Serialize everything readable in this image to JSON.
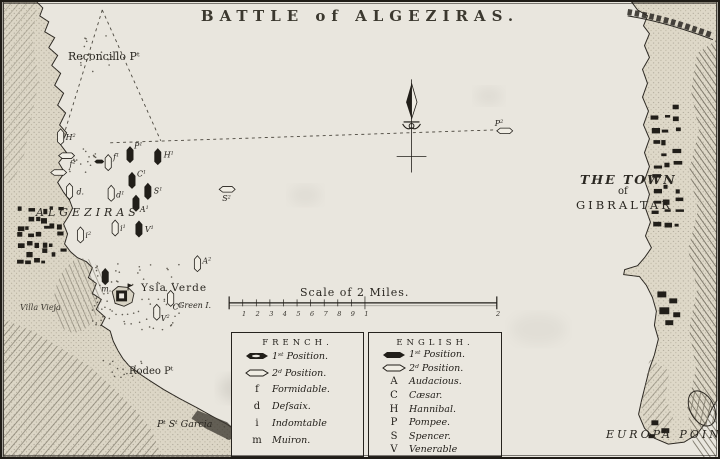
{
  "title": "BATTLE of ALGEZIRAS.",
  "colors": {
    "ink": "#211e19",
    "paper": "#e9e6de",
    "land": "#dcd6c6",
    "ship_fill": "#f0ede4"
  },
  "map_labels": {
    "reconcillo_point": "Reconcillo Pᵗ",
    "algeziras": "ALGEZIRAS",
    "villa_vieja": "Villa Vieja",
    "ysla_verde": "Ysla Verde",
    "green_island": "Green I.",
    "rodeo_point": "Rodeo Pᵗ",
    "pt_st_garcia": "Pᵗ Sᵗ Garcia",
    "the_town": "THE TOWN",
    "of_word": "of",
    "gibraltar": "GIBRALTAR",
    "europa_point": "EUROPA POINT"
  },
  "scale_bar": {
    "caption": "Scale of 2 Miles.",
    "tick_labels": [
      "1",
      "2",
      "3",
      "4",
      "5",
      "6",
      "7",
      "8",
      "9",
      "1"
    ],
    "end_label": "2"
  },
  "legend": {
    "french": {
      "header": "FRENCH.",
      "position_rows": [
        {
          "icon": "ship-1st-position-icon",
          "label": "1ˢᵗ Position."
        },
        {
          "icon": "ship-2nd-position-icon",
          "label": "2ᵈ Position."
        }
      ],
      "ship_rows": [
        {
          "key": "f",
          "name": "Formidable."
        },
        {
          "key": "d",
          "name": "Deſsaix."
        },
        {
          "key": "i",
          "name": "Indomtable"
        },
        {
          "key": "m",
          "name": "Muiron."
        }
      ]
    },
    "english": {
      "header": "ENGLISH.",
      "position_rows": [
        {
          "icon": "ship-1st-position-icon",
          "label": "1ˢᵗ Position."
        },
        {
          "icon": "ship-2nd-position-icon",
          "label": "2ᵈ Position."
        }
      ],
      "ship_rows": [
        {
          "key": "A",
          "name": "Audacious."
        },
        {
          "key": "C",
          "name": "Cæsar."
        },
        {
          "key": "H",
          "name": "Hannibal."
        },
        {
          "key": "P",
          "name": "Pompee."
        },
        {
          "key": "S",
          "name": "Spencer."
        },
        {
          "key": "V",
          "name": "Venerable"
        }
      ]
    }
  },
  "ships": [
    {
      "id": "hannibal-2",
      "x": 58,
      "y": 136,
      "orient": "v",
      "filled": false,
      "label": "H",
      "sup": "2",
      "lx": 5,
      "ly": 3
    },
    {
      "id": "formidable-2",
      "x": 64,
      "y": 155,
      "orient": "h",
      "filled": false,
      "label": "f",
      "sup": "2",
      "lx": 3,
      "ly": 11
    },
    {
      "id": "boat",
      "x": 56,
      "y": 172,
      "orient": "h",
      "filled": false,
      "label": "",
      "sup": "",
      "lx": 0,
      "ly": 0
    },
    {
      "id": "dessaix-2",
      "x": 67,
      "y": 191,
      "orient": "v",
      "filled": false,
      "label": "d",
      "sup": "",
      "dot": true,
      "lx": 7,
      "ly": 3
    },
    {
      "id": "gunboat",
      "x": 97,
      "y": 161,
      "orient": "h",
      "filled": true,
      "small": true,
      "label": "",
      "sup": "",
      "lx": 0,
      "ly": 0
    },
    {
      "id": "formidable-1",
      "x": 106,
      "y": 162,
      "orient": "v",
      "filled": false,
      "label": "f",
      "sup": "1",
      "lx": 5,
      "ly": -3
    },
    {
      "id": "pompee-1",
      "x": 128,
      "y": 154,
      "orient": "v",
      "filled": true,
      "label": "P",
      "sup": "1",
      "lx": 4,
      "ly": -6
    },
    {
      "id": "hannibal-1",
      "x": 156,
      "y": 156,
      "orient": "v",
      "filled": true,
      "label": "H",
      "sup": "1",
      "lx": 6,
      "ly": 1
    },
    {
      "id": "caesar-1",
      "x": 130,
      "y": 180,
      "orient": "v",
      "filled": true,
      "label": "C",
      "sup": "1",
      "lx": 5,
      "ly": -4
    },
    {
      "id": "dessaix-1",
      "x": 109,
      "y": 193,
      "orient": "v",
      "filled": false,
      "label": "d",
      "sup": "1",
      "lx": 5,
      "ly": 4
    },
    {
      "id": "spencer-1",
      "x": 146,
      "y": 191,
      "orient": "v",
      "filled": true,
      "label": "S",
      "sup": "1",
      "lx": 6,
      "ly": 2
    },
    {
      "id": "audacious-1",
      "x": 134,
      "y": 203,
      "orient": "v",
      "filled": true,
      "label": "A",
      "sup": "1",
      "lx": 4,
      "ly": 9
    },
    {
      "id": "indomptable-1",
      "x": 113,
      "y": 228,
      "orient": "v",
      "filled": false,
      "label": "i",
      "sup": "1",
      "lx": 5,
      "ly": 3
    },
    {
      "id": "venerable-1",
      "x": 137,
      "y": 229,
      "orient": "v",
      "filled": true,
      "label": "V",
      "sup": "1",
      "lx": 6,
      "ly": 3
    },
    {
      "id": "spencer-2",
      "x": 226,
      "y": 189,
      "orient": "h",
      "filled": false,
      "label": "S",
      "sup": "2",
      "lx": -5,
      "ly": 12
    },
    {
      "id": "muiron",
      "x": 103,
      "y": 277,
      "orient": "v",
      "filled": true,
      "label": "m",
      "sup": "",
      "dot": true,
      "lx": -4,
      "ly": 15
    },
    {
      "id": "audacious-2",
      "x": 196,
      "y": 264,
      "orient": "v",
      "filled": false,
      "label": "A",
      "sup": "2",
      "lx": 5,
      "ly": 0
    },
    {
      "id": "caesar-2",
      "x": 169,
      "y": 299,
      "orient": "v",
      "filled": false,
      "label": "C",
      "sup": "2",
      "lx": 2,
      "ly": 11
    },
    {
      "id": "venerable-2",
      "x": 155,
      "y": 313,
      "orient": "v",
      "filled": false,
      "label": "V",
      "sup": "2",
      "lx": 4,
      "ly": 9
    },
    {
      "id": "indomptable-2",
      "x": 78,
      "y": 235,
      "orient": "v",
      "filled": false,
      "label": "i",
      "sup": "2",
      "lx": 5,
      "ly": 3
    },
    {
      "id": "pompee-2",
      "x": 506,
      "y": 130,
      "orient": "h",
      "filled": false,
      "label": "P",
      "sup": "2",
      "lx": -10,
      "ly": -5
    }
  ]
}
